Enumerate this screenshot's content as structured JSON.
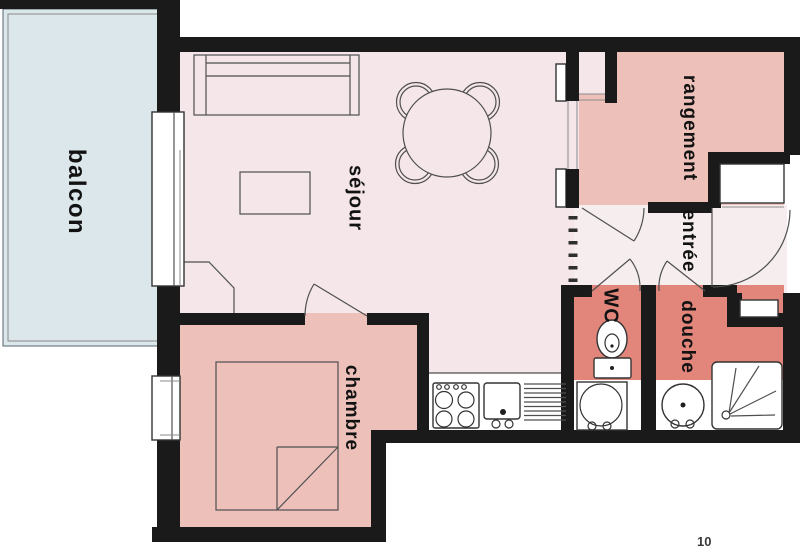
{
  "title": "apartment-floor-plan",
  "rooms": {
    "balcony": "balcon",
    "living": "séjour",
    "bedroom": "chambre",
    "storage": "rangement",
    "entry": "entrée",
    "wc": "WC",
    "shower": "douche"
  },
  "page_number": "10",
  "icons": {
    "sofa": "sofa-symbol",
    "dining_table": "round-table-with-four-chairs-symbol",
    "coffee_table": "coffee-table-symbol",
    "bed": "double-bed-symbol",
    "stove": "four-burner-stove-symbol",
    "sink": "kitchen-sink-symbol",
    "drainer": "drainboard-symbol",
    "toilet": "toilet-symbol",
    "washbasin": "washbasin-symbol",
    "washer": "appliance-round-symbol",
    "shower_tray": "shower-tray-symbol"
  },
  "colors": {
    "paper": "#ffffff",
    "wall": "#1a1a1a",
    "balcony": "#dbe7ea",
    "living": "#f4e6e9",
    "entry": "#f5edee",
    "storage": "#edc1ba",
    "wet": "#e2867b",
    "line": "#4f4f4f"
  }
}
